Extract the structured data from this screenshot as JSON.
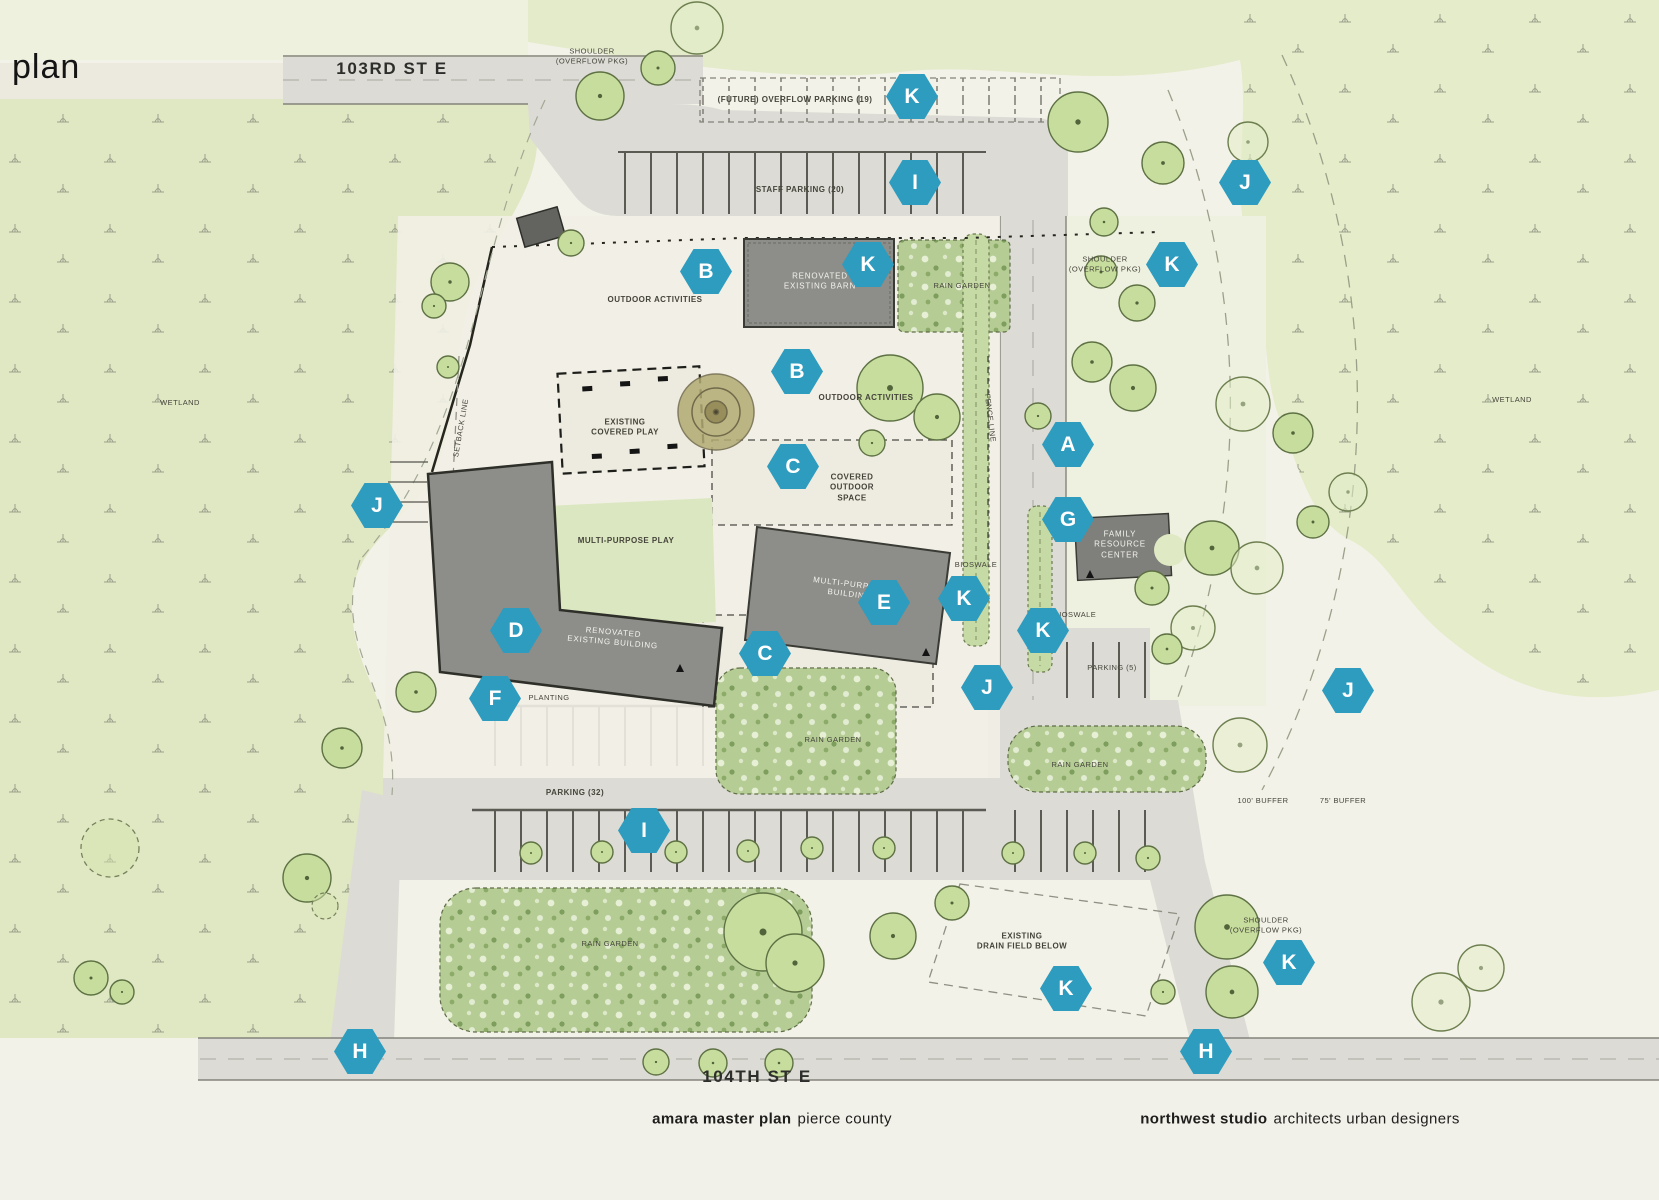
{
  "title": "plan",
  "palette": {
    "marker_teal": "#2d9cbe",
    "road_gray": "#dcdbd5",
    "building_gray": "#8d8d89",
    "wetland_green": "#e0e8c3",
    "rain_garden_green": "#b5cd95",
    "lawn_green": "#dbe7c0",
    "site_cream": "#f2f0e6"
  },
  "footer": {
    "left_bold": "amara master plan",
    "left_rest": "pierce county",
    "right_bold": "northwest studio",
    "right_rest": "architects urban designers"
  },
  "markers": [
    {
      "letter": "K",
      "x": 912,
      "y": 96
    },
    {
      "letter": "I",
      "x": 915,
      "y": 182
    },
    {
      "letter": "J",
      "x": 1245,
      "y": 182
    },
    {
      "letter": "B",
      "x": 706,
      "y": 271
    },
    {
      "letter": "K",
      "x": 868,
      "y": 264
    },
    {
      "letter": "K",
      "x": 1172,
      "y": 264
    },
    {
      "letter": "B",
      "x": 797,
      "y": 371
    },
    {
      "letter": "A",
      "x": 1068,
      "y": 444
    },
    {
      "letter": "C",
      "x": 793,
      "y": 466
    },
    {
      "letter": "J",
      "x": 377,
      "y": 505
    },
    {
      "letter": "G",
      "x": 1068,
      "y": 519
    },
    {
      "letter": "K",
      "x": 964,
      "y": 598
    },
    {
      "letter": "E",
      "x": 884,
      "y": 602
    },
    {
      "letter": "K",
      "x": 1043,
      "y": 630
    },
    {
      "letter": "D",
      "x": 516,
      "y": 630
    },
    {
      "letter": "C",
      "x": 765,
      "y": 653
    },
    {
      "letter": "J",
      "x": 987,
      "y": 687
    },
    {
      "letter": "J",
      "x": 1348,
      "y": 690
    },
    {
      "letter": "F",
      "x": 495,
      "y": 698
    },
    {
      "letter": "I",
      "x": 644,
      "y": 830
    },
    {
      "letter": "K",
      "x": 1289,
      "y": 962
    },
    {
      "letter": "K",
      "x": 1066,
      "y": 988
    },
    {
      "letter": "H",
      "x": 360,
      "y": 1051
    },
    {
      "letter": "H",
      "x": 1206,
      "y": 1051
    }
  ],
  "labels": [
    {
      "name": "street-103rd",
      "text": "103RD ST E",
      "x": 392,
      "y": 69,
      "cls": "road"
    },
    {
      "name": "street-104th",
      "text": "104TH ST E",
      "x": 757,
      "y": 1077,
      "cls": "road"
    },
    {
      "name": "shoulder-overflow-top",
      "text": "SHOULDER\n(OVERFLOW PKG)",
      "x": 592,
      "y": 56,
      "cls": "tiny"
    },
    {
      "name": "future-overflow-parking",
      "text": "(FUTURE) OVERFLOW PARKING (19)",
      "x": 795,
      "y": 100
    },
    {
      "name": "staff-parking",
      "text": "STAFF PARKING (20)",
      "x": 800,
      "y": 190
    },
    {
      "name": "outdoor-activities-1",
      "text": "OUTDOOR ACTIVITIES",
      "x": 655,
      "y": 300
    },
    {
      "name": "rain-garden-1",
      "text": "RAIN GARDEN",
      "x": 962,
      "y": 286,
      "cls": "tiny"
    },
    {
      "name": "shoulder-overflow-right",
      "text": "SHOULDER\n(OVERFLOW PKG)",
      "x": 1105,
      "y": 264,
      "cls": "tiny"
    },
    {
      "name": "wetland-left",
      "text": "WETLAND",
      "x": 180,
      "y": 403,
      "cls": "tiny"
    },
    {
      "name": "wetland-right",
      "text": "WETLAND",
      "x": 1512,
      "y": 400,
      "cls": "tiny"
    },
    {
      "name": "outdoor-activities-2",
      "text": "OUTDOOR ACTIVITIES",
      "x": 866,
      "y": 398
    },
    {
      "name": "existing-covered-play",
      "text": "EXISTING\nCOVERED PLAY",
      "x": 625,
      "y": 428
    },
    {
      "name": "covered-outdoor-space-1",
      "text": "COVERED\nOUTDOOR\nSPACE",
      "x": 852,
      "y": 488
    },
    {
      "name": "fence-line",
      "text": "FENCE LINE",
      "x": 990,
      "y": 418,
      "rot": 83,
      "cls": "tiny"
    },
    {
      "name": "setback-line",
      "text": "SETBACK LINE",
      "x": 461,
      "y": 428,
      "rot": -80,
      "cls": "tiny"
    },
    {
      "name": "multi-purpose-play",
      "text": "MULTI-PURPOSE PLAY",
      "x": 626,
      "y": 541
    },
    {
      "name": "bioswale-1",
      "text": "BIOSWALE",
      "x": 976,
      "y": 565,
      "cls": "tiny"
    },
    {
      "name": "bioswale-2",
      "text": "BIOSWALE",
      "x": 1075,
      "y": 615,
      "cls": "tiny"
    },
    {
      "name": "parking-5",
      "text": "PARKING (5)",
      "x": 1112,
      "y": 668,
      "cls": "tiny"
    },
    {
      "name": "planting",
      "text": "PLANTING",
      "x": 549,
      "y": 698,
      "cls": "tiny"
    },
    {
      "name": "rain-garden-2",
      "text": "RAIN GARDEN",
      "x": 833,
      "y": 740,
      "cls": "tiny"
    },
    {
      "name": "rain-garden-3",
      "text": "RAIN GARDEN",
      "x": 1080,
      "y": 765,
      "cls": "tiny"
    },
    {
      "name": "parking-32",
      "text": "PARKING (32)",
      "x": 575,
      "y": 793
    },
    {
      "name": "buffer-100",
      "text": "100' BUFFER",
      "x": 1263,
      "y": 801,
      "cls": "tiny"
    },
    {
      "name": "buffer-75",
      "text": "75' BUFFER",
      "x": 1343,
      "y": 801,
      "cls": "tiny"
    },
    {
      "name": "rain-garden-4",
      "text": "RAIN GARDEN",
      "x": 610,
      "y": 944,
      "cls": "tiny"
    },
    {
      "name": "existing-drain-field",
      "text": "EXISTING\nDRAIN FIELD BELOW",
      "x": 1022,
      "y": 942
    },
    {
      "name": "shoulder-overflow-bottom",
      "text": "SHOULDER\n(OVERFLOW PKG)",
      "x": 1266,
      "y": 925,
      "cls": "tiny"
    },
    {
      "name": "renovated-existing-barn",
      "text": "RENOVATED\nEXISTING BARN",
      "x": 820,
      "y": 282,
      "cls": "white"
    },
    {
      "name": "multi-purpose-building",
      "text": "MULTI-PURPOSE\nBUILDING",
      "x": 850,
      "y": 590,
      "rot": 7,
      "cls": "white"
    },
    {
      "name": "family-resource-center",
      "text": "FAMILY\nRESOURCE\nCENTER",
      "x": 1120,
      "y": 545,
      "cls": "white"
    },
    {
      "name": "renovated-existing-building",
      "text": "RENOVATED\nEXISTING BUILDING",
      "x": 613,
      "y": 638,
      "rot": 5,
      "cls": "white"
    }
  ]
}
